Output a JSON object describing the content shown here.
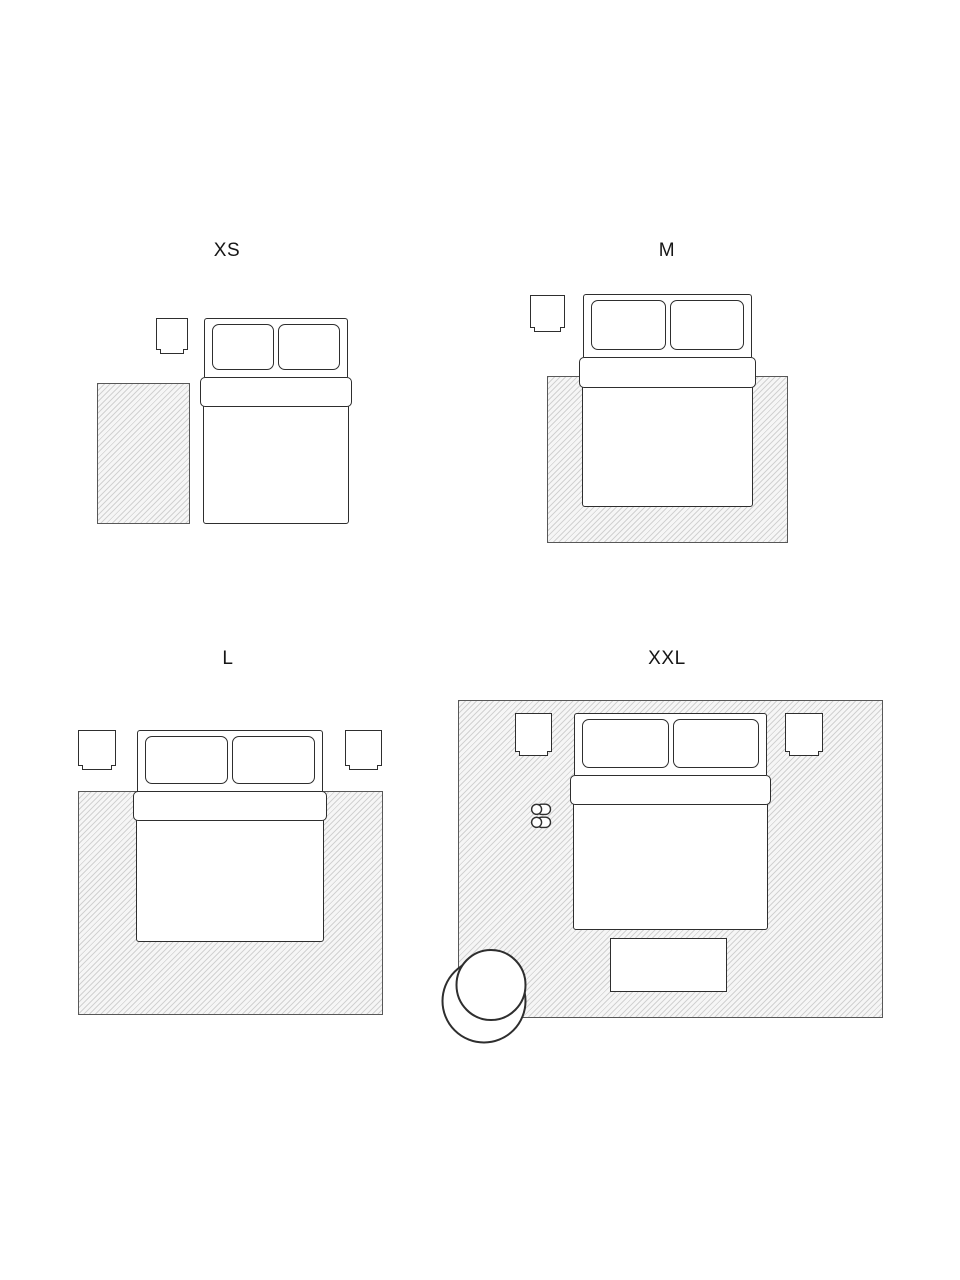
{
  "diagram": {
    "background": "#ffffff",
    "furniture_line_color": "#2e2e2e",
    "rug_border_color": "#585858",
    "rug_hatch_color": "#d2d2d2"
  },
  "sections": {
    "xs": {
      "label": "XS"
    },
    "m": {
      "label": "M"
    },
    "l": {
      "label": "L"
    },
    "xxl": {
      "label": "XXL"
    }
  }
}
